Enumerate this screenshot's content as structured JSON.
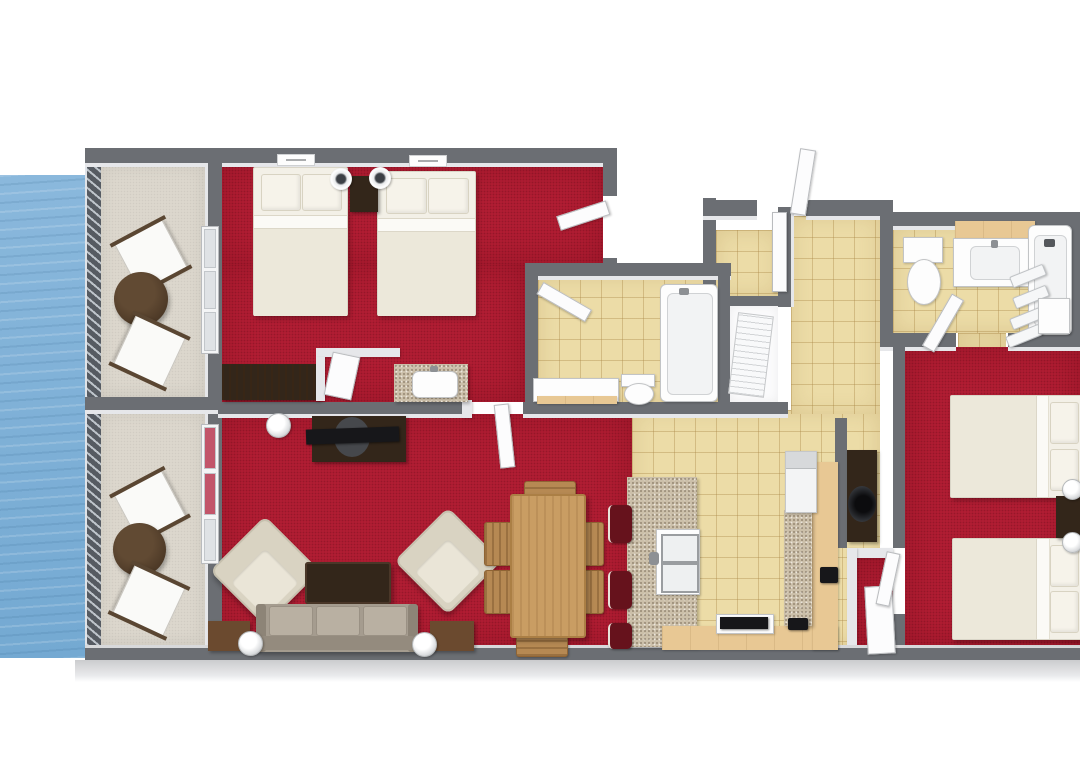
{
  "meta": {
    "type": "3d-floor-plan-rendering",
    "description": "Top-down 3D rendered floor plan of a two-bedroom, two-bath suite with red carpeted bedrooms and living-dining room, tan tiled kitchen, entry hall and bathrooms, and two furnished balconies overlooking water on the left"
  },
  "palette": {
    "water": "#7db1d7",
    "carpet": "#b11d33",
    "carpet_deep": "#8e1426",
    "tile": "#ecdca7",
    "tile_grout": "#c9aa6b",
    "balcony": "#dcd7cd",
    "wall": "#6b6e73",
    "wall_face": "#e6e7ea",
    "wall_light": "#cbccce",
    "wood_dark": "#33261a",
    "wood_mid": "#6b4a2f",
    "wood_table": "#c99d63",
    "wood_chair": "#b68953",
    "cabinet": "#e8c894",
    "granite_base": "#cbbfa9",
    "linen": "#f3f0e7",
    "linen_dim": "#ece8da",
    "pillow": "#f6f3ea",
    "fixture": "#fdfdfd",
    "fixture_line": "#c2c4c6",
    "sofa": "#a59c8f",
    "sofa_cushion": "#b9b0a2",
    "cream": "#d9d3c2",
    "cream_seat": "#eae5d7",
    "stool": "#66121c",
    "tv": "#17171a",
    "steel": "#d7d9db",
    "lamp_dark": "#3c4046"
  },
  "rooms": [
    {
      "id": "water",
      "floor": "water"
    },
    {
      "id": "balcony-upper",
      "floor": "light-beige",
      "furniture": [
        "deck-chair",
        "deck-chair",
        "round-table"
      ]
    },
    {
      "id": "balcony-lower",
      "floor": "light-beige",
      "furniture": [
        "deck-chair",
        "deck-chair",
        "round-table"
      ]
    },
    {
      "id": "bedroom-1",
      "floor": "red-carpet",
      "furniture": [
        "double-bed",
        "double-bed",
        "nightstand",
        "lamp",
        "lamp",
        "dresser",
        "vanity-granite-sink",
        "wall-plaque",
        "wall-plaque"
      ]
    },
    {
      "id": "bathroom-1",
      "floor": "tan-tile",
      "furniture": [
        "vanity",
        "toilet",
        "bathtub",
        "door"
      ]
    },
    {
      "id": "living-dining-room",
      "floor": "red-carpet",
      "furniture": [
        "tv-console",
        "tv",
        "armchair",
        "armchair",
        "coffee-table",
        "sofa",
        "end-table",
        "end-table",
        "lamp",
        "lamp",
        "dining-table",
        "dining-chair-x6"
      ]
    },
    {
      "id": "kitchen",
      "floor": "tan-tile",
      "furniture": [
        "granite-island",
        "double-sink",
        "bar-stool-x3",
        "base-cabinets",
        "range-cooktop",
        "counter",
        "refrigerator",
        "coffee-maker"
      ]
    },
    {
      "id": "entry-hall",
      "floor": "tan-tile",
      "furniture": [
        "entry-door",
        "closet-door",
        "laundry-closet"
      ]
    },
    {
      "id": "bathroom-2",
      "floor": "tan-tile",
      "furniture": [
        "toilet",
        "vanity",
        "bathtub",
        "shower-curtain",
        "shelf"
      ]
    },
    {
      "id": "bedroom-2",
      "floor": "red-carpet",
      "furniture": [
        "double-bed",
        "double-bed",
        "nightstand",
        "lamp",
        "lamp",
        "tv-console",
        "door"
      ]
    }
  ]
}
